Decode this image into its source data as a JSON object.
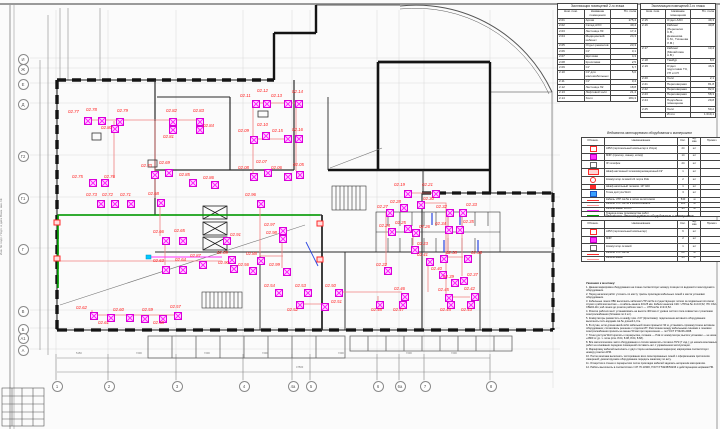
{
  "explication_left": {
    "title": "Экспликация помещений 2-го этажа",
    "col_num": "Ном. пом.",
    "col_name": "Название помещения",
    "col_area": "Пл. пола",
    "rows": [
      {
        "num": "2.01",
        "name": "Архив",
        "area": "175,4"
      },
      {
        "num": "2.02",
        "name": "Склад АХО",
        "area": "40,4"
      },
      {
        "num": "2.03",
        "name": "Лестница Л3",
        "area": "17,4"
      },
      {
        "num": "2.04",
        "name": "Медицинский кабинет",
        "area": "24,3"
      },
      {
        "num": "2.05",
        "name": "Отдел ремонтов",
        "area": "23,3"
      },
      {
        "num": "2.06",
        "name": "СУ",
        "area": "3,1"
      },
      {
        "num": "2.07",
        "name": "Щитовая",
        "area": "4,3"
      },
      {
        "num": "2.08",
        "name": "Кроссовая",
        "area": "2,5"
      },
      {
        "num": "2.09",
        "name": "СУ",
        "area": "6,7"
      },
      {
        "num": "2.10",
        "name": "СУ для маломобильных",
        "area": "5,0"
      },
      {
        "num": "2.11",
        "name": "СУ",
        "area": "3,4"
      },
      {
        "num": "2.12",
        "name": "Лестница Л2",
        "area": "18,8"
      },
      {
        "num": "2.13",
        "name": "Лифтовой холл",
        "area": "21,4"
      },
      {
        "num": "2.14",
        "name": "Холл",
        "area": "184,3"
      }
    ]
  },
  "explication_right": {
    "title": "Экспликация помещений 2-го этажа",
    "col_num": "Ном. пом.",
    "col_name": "Название помещения",
    "col_area": "Пл. пола",
    "rows": [
      {
        "num": "2.15",
        "name": "Отдел АХО",
        "area": "49,3"
      },
      {
        "num": "2.16",
        "name": "Кабинет (Перепелко С.В., Деменкова С.М., Тихонова Л.М.)",
        "area": "40,8"
      },
      {
        "num": "2.17",
        "name": "Кабинет (Михайлова А.В.)",
        "area": "13,4"
      },
      {
        "num": "2.18",
        "name": "Тамбур",
        "area": "8,0"
      },
      {
        "num": "2.19",
        "name": "Отдел подготовки ТЗ, УП и СП",
        "area": "46,9"
      },
      {
        "num": "2.20",
        "name": "Холл",
        "area": "2,1"
      },
      {
        "num": "2.21",
        "name": "Переговорная",
        "area": "81,8"
      },
      {
        "num": "2.22",
        "name": "Переговорная",
        "area": "82,6"
      },
      {
        "num": "2.23",
        "name": "Переговорная",
        "area": "58,3"
      },
      {
        "num": "2.24",
        "name": "Подсобное помещение",
        "area": "29,8"
      },
      {
        "num": "2.25",
        "name": "Холл",
        "area": "50,2"
      },
      {
        "num": "",
        "name": "Итого",
        "area": "1 019,1"
      }
    ]
  },
  "legend_mount": {
    "title": "Ведомость монтируемого оборудования и материалов",
    "cols": {
      "sym": "Обознач.",
      "name": "Наименование",
      "qty": "Кол.",
      "unit": "Ед. изм.",
      "note": "Примеч."
    },
    "rows": [
      {
        "sym": "sq-red",
        "name": "АРМ (персональный компьютер в сборе)",
        "qty": "24",
        "unit": "шт",
        "note": ""
      },
      {
        "sym": "sq-mag",
        "name": "МФУ (принтер, сканер, копир)",
        "qty": "14",
        "unit": "шт",
        "note": ""
      },
      {
        "sym": "sq-plain",
        "name": "IP-телефон",
        "qty": "24",
        "unit": "шт",
        "note": ""
      },
      {
        "sym": "rect-red",
        "name": "Шкаф настенный телекоммуникационный 19\"",
        "qty": "1",
        "unit": "шт",
        "note": ""
      },
      {
        "sym": "circ-red",
        "name": "Коммутатор сетевой 24 порта PoE",
        "qty": "2",
        "unit": "шт",
        "note": ""
      },
      {
        "sym": "e-red",
        "name": "Шкаф напольный телеком. 19\" 42U",
        "qty": "1",
        "unit": "шт",
        "note": ""
      },
      {
        "sym": "sq-blue",
        "name": "Точка доступа Wi-Fi",
        "qty": "3",
        "unit": "шт",
        "note": ""
      },
      {
        "sym": "line-red",
        "name": "Кабель UTP cat.5e в лотке за потолком",
        "qty": "540",
        "unit": "м",
        "note": ""
      },
      {
        "sym": "line-pink",
        "name": "Кабель UTP cat.5e в кабель-канале",
        "qty": "120",
        "unit": "м",
        "note": ""
      },
      {
        "sym": "line-mag",
        "name": "Кабель-канал 40×25",
        "qty": "95",
        "unit": "м",
        "note": ""
      },
      {
        "sym": "line-green",
        "name": "Граница зоны производства работ",
        "qty": "",
        "unit": "",
        "note": ""
      }
    ]
  },
  "legend_demount": {
    "title": "Ведомость демонтируемого оборудования и материалов",
    "cols": {
      "sym": "Обознач.",
      "name": "Наименование",
      "qty": "Кол.",
      "unit": "Ед. изм.",
      "note": "Примеч."
    },
    "rows": [
      {
        "sym": "sq-red",
        "name": "АРМ (персональный компьютер)",
        "qty": "6",
        "unit": "шт",
        "note": ""
      },
      {
        "sym": "sq-mag",
        "name": "МФУ",
        "qty": "2",
        "unit": "шт",
        "note": ""
      },
      {
        "sym": "sq-plain",
        "name": "Коммутатор сетевой",
        "qty": "1",
        "unit": "шт",
        "note": ""
      },
      {
        "sym": "line-red",
        "name": "Кабель UTP cat.5e",
        "qty": "80",
        "unit": "м",
        "note": ""
      },
      {
        "sym": "line-pink",
        "name": "Кабель-канал",
        "qty": "45",
        "unit": "м",
        "note": ""
      }
    ]
  },
  "notes": {
    "title": "Указания к монтажу:",
    "lines": [
      "1. Данная маркировка оборудования на плане соответствует номеру позиции по ведомости монтируемого оборудования.",
      "2. Перед началом работ уточнить по месту трассы прокладки кабельных линий и места установки оборудования.",
      "3. Кабельные линии ЛВС выполнить кабелем UTP cat.5e в существующих лотках за подвесным потолком; спуски к рабочим местам — в кабель-канале 40×25 мм. Кабели каналов СКС: UTPcat.5e 4×2×0,52; ITK CS2-C5E04-111; каб.линии до розеток рабочих мест — UTPcat.5e 2×2×0,52.",
      "4. Розетки рабочих мест устанавливать на высоте 400 мм от уровня чистого пола совместно с розетками электроснабжения (блоками по 2 шт).",
      "5. Коммутаторы разместить в шкафу пом. 2.07 (Кроссовая); подключение активного оборудования выполнить патч-кордами cat.5e длиной 1,0 м.",
      "6. В случае, если длина какой-либо кабельной линии превысит 90 м, установить промежуточное активное оборудование; согласовать решение с отделом ИТ. Расстояние между кабельными линиями и линиями электроснабжения принять не менее 50 мм при пересечении — по ГОСТ Р 53246-2008.",
      "7. Точки доступа Wi-Fi крепить к перекрытию, питание — PoE от коммутатора; высота установки — не ниже +2800 от ур. ч. пола (отм. 8.04, 8.08, 8.64, 8.68).",
      "8. Все металлические части оборудования и лотков заземлить согласно ПУЭ (7 изд.); до начала монтажных работ на основании передачи помещений составить акт с управлением эксплуатации.",
      "9. Маркировку кабелей выполнить с двух сторон несмываемым маркером; маркировка соответствует номеру розетки АРМ.",
      "10. После монтажа выполнить тестирование всех смонтированных линий с оформлением протоколов измерений; демонтируемое оборудование передать заказчику по акту.",
      "11. Отверстия в стенах и перекрытиях после прокладки кабелей заделать негорючим материалом.",
      "12. Работы выполнять в соответствии с СП 76.13330, ГОСТ Р 53245/53246 и действующими нормами ПБ."
    ]
  },
  "axes_bottom": [
    {
      "label": "1",
      "x": 56,
      "y": 385
    },
    {
      "label": "2",
      "x": 108,
      "y": 385
    },
    {
      "label": "3",
      "x": 176,
      "y": 385
    },
    {
      "label": "4",
      "x": 243,
      "y": 385
    },
    {
      "label": "4а",
      "x": 292,
      "y": 385
    },
    {
      "label": "5",
      "x": 310,
      "y": 385
    },
    {
      "label": "6",
      "x": 377,
      "y": 385
    },
    {
      "label": "6а",
      "x": 399,
      "y": 385
    },
    {
      "label": "7",
      "x": 424,
      "y": 385
    },
    {
      "label": "8",
      "x": 490,
      "y": 385
    }
  ],
  "axes_left": [
    {
      "label": "И",
      "x": 22,
      "y": 58
    },
    {
      "label": "Ж",
      "x": 22,
      "y": 68
    },
    {
      "label": "Е",
      "x": 22,
      "y": 83
    },
    {
      "label": "Д",
      "x": 22,
      "y": 103
    },
    {
      "label": "Г2",
      "x": 22,
      "y": 155
    },
    {
      "label": "Г1",
      "x": 22,
      "y": 197
    },
    {
      "label": "Г",
      "x": 22,
      "y": 248
    },
    {
      "label": "В",
      "x": 22,
      "y": 310
    },
    {
      "label": "Б",
      "x": 22,
      "y": 328
    },
    {
      "label": "А1",
      "x": 22,
      "y": 337
    },
    {
      "label": "А",
      "x": 22,
      "y": 349
    }
  ],
  "dim_labels": [
    {
      "t": "5150",
      "x": 76,
      "y": 352
    },
    {
      "t": "7200",
      "x": 136,
      "y": 352
    },
    {
      "t": "7200",
      "x": 204,
      "y": 352
    },
    {
      "t": "7200",
      "x": 262,
      "y": 352
    },
    {
      "t": "7200",
      "x": 338,
      "y": 352
    },
    {
      "t": "7200",
      "x": 406,
      "y": 352
    },
    {
      "t": "7200",
      "x": 451,
      "y": 352
    },
    {
      "t": "47500",
      "x": 296,
      "y": 366
    }
  ],
  "markers": [
    {
      "l": "02.77",
      "x": 84,
      "y": 117,
      "lx": 68,
      "ly": 109
    },
    {
      "l": "02.78",
      "x": 98,
      "y": 117,
      "lx": 86,
      "ly": 107
    },
    {
      "l": "02.79",
      "x": 116,
      "y": 118,
      "lx": 117,
      "ly": 108
    },
    {
      "l": "02.80",
      "x": 111,
      "y": 125,
      "lx": 101,
      "ly": 125
    },
    {
      "l": "02.82",
      "x": 169,
      "y": 118,
      "lx": 166,
      "ly": 108
    },
    {
      "l": "02.83",
      "x": 196,
      "y": 118,
      "lx": 193,
      "ly": 108
    },
    {
      "l": "02.81",
      "x": 169,
      "y": 126,
      "lx": 163,
      "ly": 134
    },
    {
      "l": "02.84",
      "x": 196,
      "y": 126,
      "lx": 203,
      "ly": 123
    },
    {
      "l": "02.75",
      "x": 89,
      "y": 179,
      "lx": 72,
      "ly": 174
    },
    {
      "l": "02.76",
      "x": 101,
      "y": 179,
      "lx": 104,
      "ly": 174
    },
    {
      "l": "02.70",
      "x": 151,
      "y": 171,
      "lx": 141,
      "ly": 163
    },
    {
      "l": "02.69",
      "x": 165,
      "y": 169,
      "lx": 159,
      "ly": 160
    },
    {
      "l": "02.85",
      "x": 189,
      "y": 179,
      "lx": 179,
      "ly": 172
    },
    {
      "l": "02.86",
      "x": 211,
      "y": 181,
      "lx": 203,
      "ly": 175
    },
    {
      "l": "02.73",
      "x": 97,
      "y": 200,
      "lx": 86,
      "ly": 192
    },
    {
      "l": "02.72",
      "x": 111,
      "y": 200,
      "lx": 102,
      "ly": 192
    },
    {
      "l": "02.71",
      "x": 127,
      "y": 200,
      "lx": 120,
      "ly": 192
    },
    {
      "l": "02.68",
      "x": 157,
      "y": 199,
      "lx": 148,
      "ly": 191
    },
    {
      "l": "02.66",
      "x": 162,
      "y": 237,
      "lx": 153,
      "ly": 229
    },
    {
      "l": "02.65",
      "x": 179,
      "y": 237,
      "lx": 174,
      "ly": 228
    },
    {
      "l": "02.63",
      "x": 162,
      "y": 266,
      "lx": 153,
      "ly": 258
    },
    {
      "l": "02.64",
      "x": 179,
      "y": 266,
      "lx": 175,
      "ly": 257
    },
    {
      "l": "02.87",
      "x": 199,
      "y": 261,
      "lx": 190,
      "ly": 253
    },
    {
      "l": "02.62",
      "x": 90,
      "y": 312,
      "lx": 76,
      "ly": 305
    },
    {
      "l": "02.61",
      "x": 107,
      "y": 314,
      "lx": 98,
      "ly": 320
    },
    {
      "l": "02.60",
      "x": 126,
      "y": 314,
      "lx": 113,
      "ly": 307
    },
    {
      "l": "02.59",
      "x": 141,
      "y": 315,
      "lx": 142,
      "ly": 307
    },
    {
      "l": "02.58",
      "x": 159,
      "y": 315,
      "lx": 153,
      "ly": 320
    },
    {
      "l": "02.57",
      "x": 174,
      "y": 312,
      "lx": 170,
      "ly": 304
    },
    {
      "l": "02.11",
      "x": 252,
      "y": 100,
      "lx": 240,
      "ly": 93
    },
    {
      "l": "02.12",
      "x": 263,
      "y": 100,
      "lx": 257,
      "ly": 88
    },
    {
      "l": "02.13",
      "x": 284,
      "y": 100,
      "lx": 271,
      "ly": 93
    },
    {
      "l": "02.14",
      "x": 295,
      "y": 100,
      "lx": 292,
      "ly": 89
    },
    {
      "l": "02.09",
      "x": 250,
      "y": 136,
      "lx": 238,
      "ly": 128
    },
    {
      "l": "02.10",
      "x": 262,
      "y": 132,
      "lx": 257,
      "ly": 122
    },
    {
      "l": "02.15",
      "x": 284,
      "y": 135,
      "lx": 272,
      "ly": 128
    },
    {
      "l": "02.16",
      "x": 295,
      "y": 135,
      "lx": 292,
      "ly": 127
    },
    {
      "l": "02.08",
      "x": 250,
      "y": 173,
      "lx": 238,
      "ly": 165
    },
    {
      "l": "02.07",
      "x": 264,
      "y": 169,
      "lx": 256,
      "ly": 159
    },
    {
      "l": "02.06",
      "x": 284,
      "y": 173,
      "lx": 271,
      "ly": 165
    },
    {
      "l": "02.05",
      "x": 296,
      "y": 171,
      "lx": 293,
      "ly": 162
    },
    {
      "l": "02.96",
      "x": 257,
      "y": 200,
      "lx": 245,
      "ly": 192
    },
    {
      "l": "02.97",
      "x": 279,
      "y": 227,
      "lx": 264,
      "ly": 222
    },
    {
      "l": "02.98",
      "x": 279,
      "y": 235,
      "lx": 266,
      "ly": 230
    },
    {
      "l": "02.91",
      "x": 223,
      "y": 237,
      "lx": 230,
      "ly": 232
    },
    {
      "l": "02.99",
      "x": 283,
      "y": 268,
      "lx": 269,
      "ly": 262
    },
    {
      "l": "02.89",
      "x": 228,
      "y": 256,
      "lx": 217,
      "ly": 250
    },
    {
      "l": "02.90",
      "x": 230,
      "y": 265,
      "lx": 218,
      "ly": 260
    },
    {
      "l": "02.88",
      "x": 257,
      "y": 257,
      "lx": 246,
      "ly": 251
    },
    {
      "l": "02.56",
      "x": 249,
      "y": 267,
      "lx": 238,
      "ly": 262
    },
    {
      "l": "02.54",
      "x": 275,
      "y": 289,
      "lx": 264,
      "ly": 283
    },
    {
      "l": "02.53",
      "x": 304,
      "y": 289,
      "lx": 295,
      "ly": 283
    },
    {
      "l": "02.50",
      "x": 335,
      "y": 289,
      "lx": 325,
      "ly": 283
    },
    {
      "l": "02.52",
      "x": 296,
      "y": 301,
      "lx": 287,
      "ly": 307
    },
    {
      "l": "02.51",
      "x": 321,
      "y": 303,
      "lx": 331,
      "ly": 299
    },
    {
      "l": "02.48",
      "x": 376,
      "y": 301,
      "lx": 371,
      "ly": 307
    },
    {
      "l": "02.47",
      "x": 399,
      "y": 301,
      "lx": 393,
      "ly": 307
    },
    {
      "l": "02.46",
      "x": 401,
      "y": 293,
      "lx": 394,
      "ly": 286
    },
    {
      "l": "02.45",
      "x": 445,
      "y": 294,
      "lx": 438,
      "ly": 287
    },
    {
      "l": "02.44",
      "x": 447,
      "y": 301,
      "lx": 440,
      "ly": 307
    },
    {
      "l": "02.43",
      "x": 467,
      "y": 301,
      "lx": 461,
      "ly": 307
    },
    {
      "l": "02.42",
      "x": 471,
      "y": 293,
      "lx": 464,
      "ly": 286
    },
    {
      "l": "02.19",
      "x": 404,
      "y": 190,
      "lx": 394,
      "ly": 182
    },
    {
      "l": "02.21",
      "x": 432,
      "y": 190,
      "lx": 422,
      "ly": 182
    },
    {
      "l": "02.30",
      "x": 417,
      "y": 201,
      "lx": 423,
      "ly": 196
    },
    {
      "l": "02.28",
      "x": 400,
      "y": 204,
      "lx": 390,
      "ly": 199
    },
    {
      "l": "02.32",
      "x": 446,
      "y": 209,
      "lx": 436,
      "ly": 204
    },
    {
      "l": "02.33",
      "x": 459,
      "y": 209,
      "lx": 466,
      "ly": 202
    },
    {
      "l": "02.27",
      "x": 386,
      "y": 209,
      "lx": 377,
      "ly": 204
    },
    {
      "l": "02.26",
      "x": 412,
      "y": 229,
      "lx": 419,
      "ly": 224
    },
    {
      "l": "02.34",
      "x": 445,
      "y": 226,
      "lx": 435,
      "ly": 221
    },
    {
      "l": "02.35",
      "x": 456,
      "y": 226,
      "lx": 463,
      "ly": 219
    },
    {
      "l": "02.25",
      "x": 404,
      "y": 225,
      "lx": 395,
      "ly": 220
    },
    {
      "l": "02.24",
      "x": 388,
      "y": 228,
      "lx": 379,
      "ly": 223
    },
    {
      "l": "02.23",
      "x": 411,
      "y": 246,
      "lx": 417,
      "ly": 241
    },
    {
      "l": "02.22",
      "x": 384,
      "y": 267,
      "lx": 376,
      "ly": 262
    },
    {
      "l": "02.41",
      "x": 426,
      "y": 258,
      "lx": 417,
      "ly": 252
    },
    {
      "l": "02.38",
      "x": 440,
      "y": 255,
      "lx": 446,
      "ly": 250
    },
    {
      "l": "02.36",
      "x": 464,
      "y": 255,
      "lx": 471,
      "ly": 250
    },
    {
      "l": "02.40",
      "x": 439,
      "y": 271,
      "lx": 431,
      "ly": 266
    },
    {
      "l": "02.39",
      "x": 451,
      "y": 279,
      "lx": 443,
      "ly": 274
    },
    {
      "l": "02.37",
      "x": 460,
      "y": 277,
      "lx": 467,
      "ly": 272
    }
  ],
  "side_text": "Инв. № подл.      Подп. и дата      Взам. инв. №",
  "colors": {
    "wall": "#141414",
    "grid": "#d9d9d9",
    "cable": "#f08080",
    "equip": "#ff30ff",
    "label": "#ff2020",
    "green": "#00a300",
    "cyan": "#00c8ff",
    "blue": "#2b46e0"
  }
}
